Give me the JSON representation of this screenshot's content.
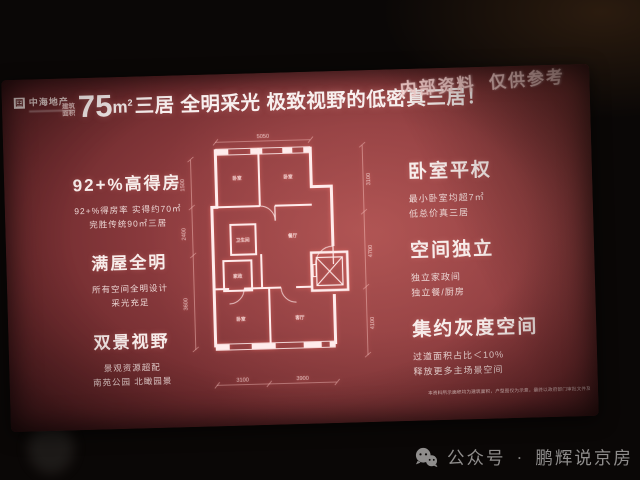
{
  "logo": {
    "name": "中海地产"
  },
  "title": {
    "small_label_top": "建筑",
    "small_label_bottom": "面积",
    "area": "75",
    "unit_base": "m",
    "unit_sup": "2",
    "headline": "三居 全明采光 极致视野的低密真三居！"
  },
  "stamp": "内部资料  仅供参考",
  "left_features": [
    {
      "heading": "92+%高得房",
      "line1": "92+%得房率 实得约70㎡",
      "line2": "完胜传统90㎡三居"
    },
    {
      "heading": "满屋全明",
      "line1": "所有空间全明设计",
      "line2": "采光充足"
    },
    {
      "heading": "双景视野",
      "line1": "景观资源超配",
      "line2": "南苑公园 北瞰园景"
    }
  ],
  "right_features": [
    {
      "heading": "卧室平权",
      "line1": "最小卧室均超7㎡",
      "line2": "低总价真三居"
    },
    {
      "heading": "空间独立",
      "line1": "独立家政间",
      "line2": "独立餐/厨房"
    },
    {
      "heading": "集约灰度空间",
      "line1": "过道面积占比＜10%",
      "line2": "释放更多主场景空间"
    }
  ],
  "floorplan": {
    "dim_top": "5050",
    "dims_right": [
      "3100",
      "4700",
      "4100"
    ],
    "dims_bottom": [
      "3100",
      "3900"
    ],
    "dims_left": [
      "1500",
      "2400",
      "3600"
    ],
    "rooms": [
      "卧室",
      "卧室",
      "卫生间",
      "家政",
      "餐厅",
      "客厅",
      "卧室"
    ]
  },
  "disclaimer": "本资料所示面积均为建筑面积，户型图仅为示意，最终以政府部门审批文件及商品房买卖合同约定为准，不构成要约或承诺。",
  "footer": {
    "label": "公众号",
    "separator": "·",
    "name": "鹏辉说京房"
  }
}
